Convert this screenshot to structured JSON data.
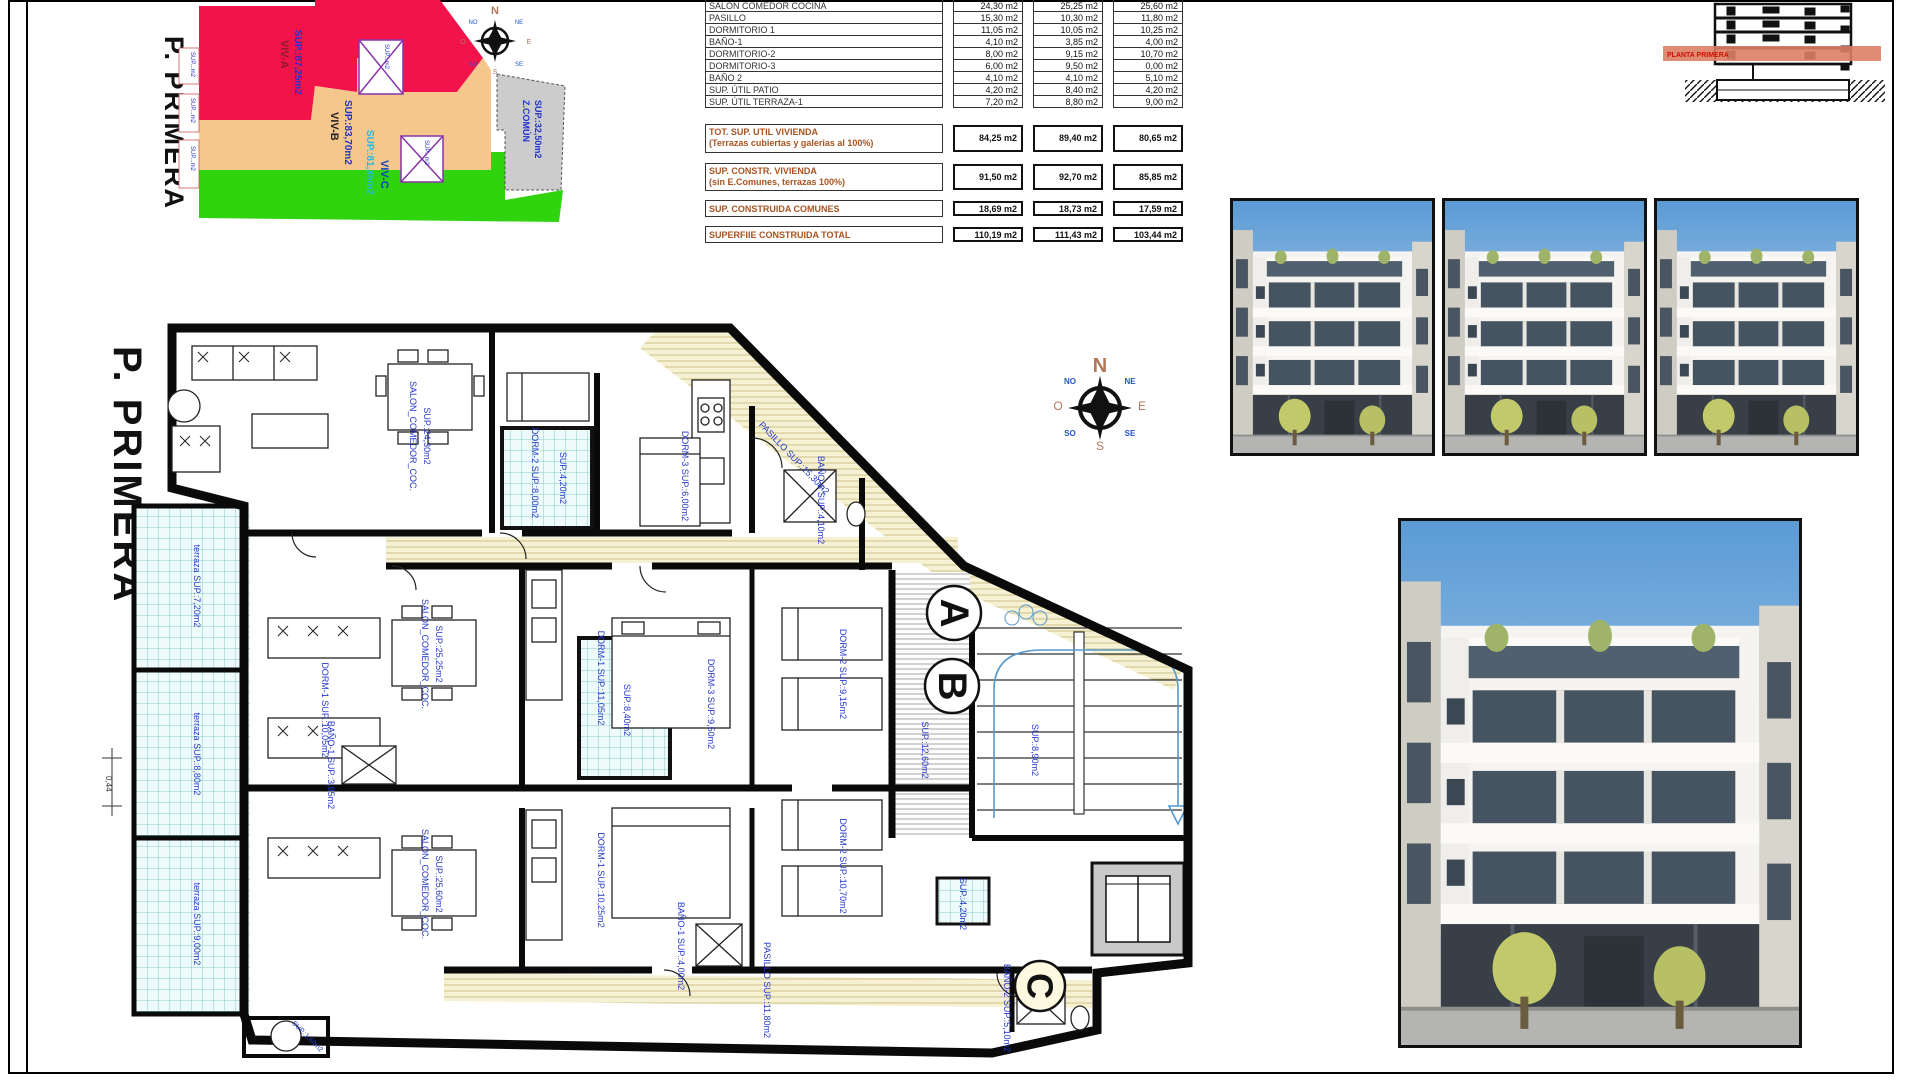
{
  "sheet": {
    "floor_title": "P. PRIMERA"
  },
  "site_plan": {
    "title": "P. PRIMERA",
    "zones": [
      {
        "name": "VIV-A",
        "sup": "SUP.:87,25m2"
      },
      {
        "name": "VIV-B",
        "sup": "SUP.:83,70m2"
      },
      {
        "name": "VIV-C",
        "sup": "SUP.:81,35m2"
      },
      {
        "name": "Z.COMÚN",
        "sup": "SUP.:32,50m2"
      }
    ],
    "edge_labels": [
      "SUP...m2",
      "SUP...m2",
      "SUP...m2"
    ],
    "patio_labels": [
      "SUP...m2",
      "SUP...m2"
    ]
  },
  "area_table": {
    "rows": [
      {
        "label": "SALON COMEDOR COCINA",
        "a": "24,30 m2",
        "b": "25,25 m2",
        "c": "25,60 m2"
      },
      {
        "label": "PASILLO",
        "a": "15,30 m2",
        "b": "10,30 m2",
        "c": "11,80 m2"
      },
      {
        "label": "DORMITORIO 1",
        "a": "11,05 m2",
        "b": "10,05 m2",
        "c": "10,25 m2"
      },
      {
        "label": "BAÑO-1",
        "a": "4,10 m2",
        "b": "3,85 m2",
        "c": "4,00 m2"
      },
      {
        "label": "DORMITORIO-2",
        "a": "8,00 m2",
        "b": "9,15 m2",
        "c": "10,70 m2"
      },
      {
        "label": "DORMITORIO-3",
        "a": "6,00 m2",
        "b": "9,50 m2",
        "c": "0,00 m2"
      },
      {
        "label": "BAÑO 2",
        "a": "4,10 m2",
        "b": "4,10 m2",
        "c": "5,10 m2"
      },
      {
        "label": "SUP. ÚTIL PATIO",
        "a": "4,20 m2",
        "b": "8,40 m2",
        "c": "4,20 m2"
      },
      {
        "label": "SUP. ÚTIL TERRAZA-1",
        "a": "7,20 m2",
        "b": "8,80 m2",
        "c": "9,00 m2"
      }
    ],
    "summary": [
      {
        "label": "TOT. SUP. UTIL VIVIENDA",
        "note": "(Terrazas cubiertas y galerias al 100%)",
        "a": "84,25 m2",
        "b": "89,40 m2",
        "c": "80,65 m2"
      },
      {
        "label": "SUP. CONSTR. VIVIENDA",
        "note": "(sin E.Comunes, terrazas 100%)",
        "a": "91,50 m2",
        "b": "92,70 m2",
        "c": "85,85 m2"
      },
      {
        "label": "SUP. CONSTRUIDA COMUNES",
        "note": "",
        "a": "18,69 m2",
        "b": "18,73 m2",
        "c": "17,59 m2"
      },
      {
        "label": "SUPERFIIE CONSTRUIDA TOTAL",
        "note": "",
        "a": "110,19 m2",
        "b": "111,43 m2",
        "c": "103,44 m2"
      }
    ]
  },
  "section": {
    "band_label": "PLANTA PRIMERA"
  },
  "compass": {
    "n": "N",
    "e": "E",
    "s": "S",
    "o": "O",
    "ne": "NE",
    "no": "NO",
    "se": "SE",
    "so": "SO"
  },
  "floor_plan": {
    "title": "P. PRIMERA",
    "circles": {
      "a": "A",
      "b": "B",
      "c": "C"
    },
    "dimension": "0,44",
    "labels": [
      {
        "t": "SALON_COMEDOR_COC."
      },
      {
        "t": "SUP.:24,30m2"
      },
      {
        "t": "PASILLO  SUP.:15,30m2"
      },
      {
        "t": "DORM-2  SUP.:8,00m2"
      },
      {
        "t": "SUP.:4,20m2"
      },
      {
        "t": "DORM-3  SUP.:6,00m2"
      },
      {
        "t": "BAÑO-2  SUP.:4,10m2"
      },
      {
        "t": "terraza  SUP.:7,20m2"
      },
      {
        "t": "terraza  SUP.:8,80m2"
      },
      {
        "t": "terraza  SUP.:9,00m2"
      },
      {
        "t": "SALON_COMEDOR_COC."
      },
      {
        "t": "SUP.:25,25m2"
      },
      {
        "t": "DORM-1  SUP.:11,05m2"
      },
      {
        "t": "DORM-2  SUP.:9,15m2"
      },
      {
        "t": "SUP.:8,40m2"
      },
      {
        "t": "BAÑO-1  SUP.:3,85m2"
      },
      {
        "t": "SUP.:12,60m2"
      },
      {
        "t": "SUP.:8,90m2"
      },
      {
        "t": "SALON_COMEDOR_COC."
      },
      {
        "t": "SUP.:25,60m2"
      },
      {
        "t": "DORM-1  SUP.:10,25m2"
      },
      {
        "t": "DORM-2  SUP.:10,70m2"
      },
      {
        "t": "DORM-3  SUP.:9,50m2"
      },
      {
        "t": "BAÑO-1  SUP.:4,00m2"
      },
      {
        "t": "PASILLO  SUP.:11,80m2"
      },
      {
        "t": "BAÑO-2  SUP.:5,10m2"
      },
      {
        "t": "SUP.:4,20m2"
      },
      {
        "t": "DORM-1  SUP.:10,05m2"
      },
      {
        "t": "SUP.:1,60m2"
      }
    ]
  }
}
